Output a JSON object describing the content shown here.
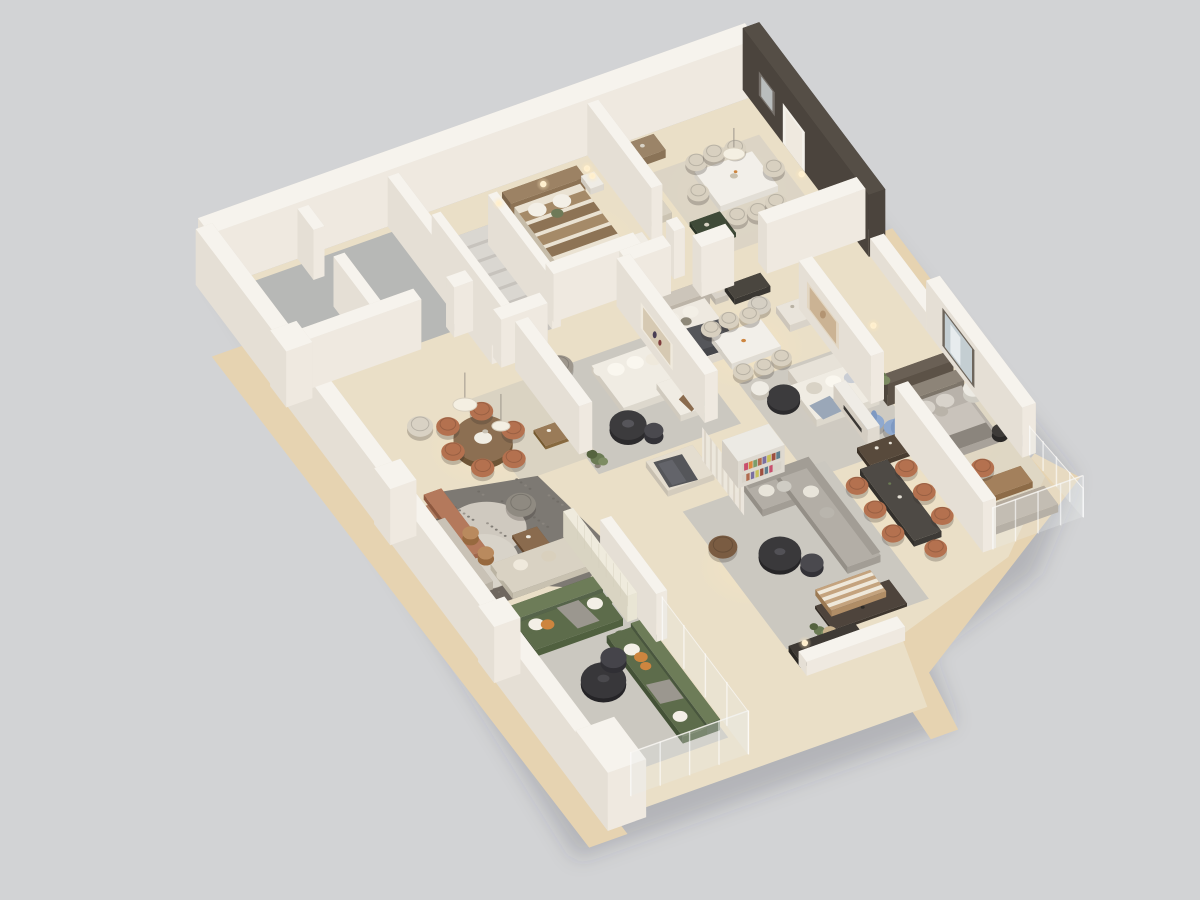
{
  "scene": {
    "name": "isometric-3d-apartment-floorplan-render",
    "background": "#d2d3d5",
    "shadow": "rgba(60,62,66,0.20)",
    "floor": {
      "wood": "#eadfc7",
      "wood_warm": "#f0e2c2",
      "balcony": "#e6d3b1",
      "gray_room": "#b7b8b6",
      "kitchen_dark": "#6f675f",
      "copper_strip": "#ad7b5f"
    },
    "walls": {
      "top": "#f6f3ed",
      "face_light": "#efe9e0",
      "face_mid": "#e5dfd5",
      "face_shadow": "#d8d1c7",
      "accent_dark_top": "#554e46",
      "accent_dark_face": "#4b443d",
      "accent_dark_end": "#3e3833",
      "tile": "#e9e5d4",
      "tile_line": "#d3cebb",
      "glass": "#e8eeee",
      "headboard_panel": "#5c5247",
      "door_white": "#f4f1ea"
    },
    "rugs": {
      "light": "#cbc8c0",
      "beige": "#d6cfc1",
      "mottled_dark": "#7d7973",
      "mottled_light": "#cfc9bf",
      "pale_round": "#d8d3c9",
      "dining": "#d9d2c4"
    },
    "furniture": {
      "sofa_green": "#5d6c4b",
      "sofa_green_back": "#6d7c58",
      "sofa_brown": "#8a7263",
      "sofa_brown_back": "#7a6557",
      "sofa_white": "#f0ece3",
      "sofa_beige": "#d9d2c3",
      "sectional_gray": "#b3aea6",
      "sectional_gray_back": "#a29d95",
      "bed_stripe_a": "#a58a68",
      "bed_stripe_b": "#8d7355",
      "bed_cream": "#eae2d2",
      "bed_gray": "#b8b2aa",
      "bed_gray_duvet": "#c9c3bb",
      "headboard_wood": "#9c8264",
      "throw_dark": "#55565a",
      "chair_terracotta": "#b4714f",
      "chair_beige": "#d8d0c0",
      "chair_gray": "#9d968c",
      "chair_blue": "#8fa9cf",
      "chair_leather": "#7a5c42",
      "table_dark": "#3c3b3d",
      "table_dark2": "#46454a",
      "table_wood": "#9a7b58",
      "table_marble": "#f2efe9",
      "table_green_dark": "#3f4a38",
      "console_dark": "#584a3c",
      "console_taupe": "#b5ab9d",
      "sideboard_wood": "#9b8468",
      "dresser_white": "#e9e4db",
      "stairs_top": "#dad7d1",
      "stairs_side": "#c7c3bd",
      "pillow_white": "#f3efe6",
      "pillow_orange": "#cd853f",
      "plant_green": "#6b7b54",
      "plant_green_dark": "#55633f",
      "pampas": "#c9b28c",
      "lamp_glow": "#ffe9bd",
      "lamp_dot": "#fff6e0",
      "art_frame": "#77716b",
      "art_inner": "#c2bab0",
      "art_canvas": "#d6c9b2",
      "mirror": "#c4ced2",
      "books": [
        "#c94f6d",
        "#d98a3f",
        "#7a9e6b",
        "#b06a4f",
        "#7a6fa0",
        "#c9c05a",
        "#9e4f3f",
        "#5f7d8c"
      ]
    }
  },
  "rooms": [
    {
      "name": "empty-room-a"
    },
    {
      "name": "empty-room-b"
    },
    {
      "name": "staircase"
    },
    {
      "name": "bedroom-guest"
    },
    {
      "name": "dining-room-top"
    },
    {
      "name": "bedroom-center"
    },
    {
      "name": "open-dining-center"
    },
    {
      "name": "formal-living"
    },
    {
      "name": "family-living"
    },
    {
      "name": "master-bedroom"
    },
    {
      "name": "dining-room-right"
    },
    {
      "name": "living-gray-sectional"
    },
    {
      "name": "den-lounge"
    },
    {
      "name": "round-dining-left"
    },
    {
      "name": "kitchen-nook"
    },
    {
      "name": "green-sofa-living"
    },
    {
      "name": "balcony-walkway"
    }
  ]
}
